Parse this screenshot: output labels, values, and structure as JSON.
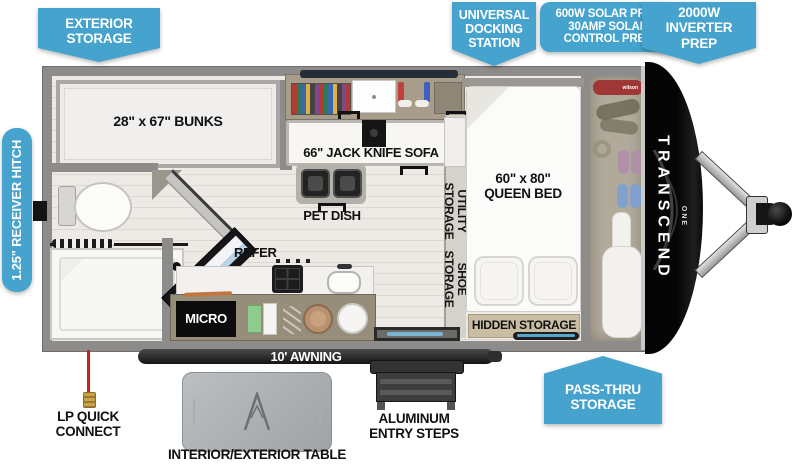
{
  "colors": {
    "callout_blue": "#45a3cd",
    "wall_gray": "#8e8c8a",
    "floor_tan": "#ece9e3",
    "cap_black": "#0d0d0d",
    "label_black": "#111111",
    "awning_black": "#1c1c1c",
    "accent_tray_blue": "#58a8cc"
  },
  "callouts": {
    "exterior_storage": "EXTERIOR STORAGE",
    "universal_docking": "UNIVERSAL DOCKING STATION",
    "solar": {
      "lines": [
        "600W SOLAR PREP",
        "30AMP SOLAR",
        "CONTROL PREP"
      ]
    },
    "inverter": "2000W INVERTER PREP",
    "receiver_hitch": "1.25\" RECEIVER HITCH",
    "pass_thru": "PASS-THRU STORAGE"
  },
  "rooms": {
    "bunks": "28\" x 67\" BUNKS",
    "sofa": "66\" JACK KNIFE SOFA",
    "pet_dish": "PET DISH",
    "refer": "REFER",
    "micro": "MICRO",
    "utility_storage": "UTILITY STORAGE",
    "shoe_storage": "SHOE STORAGE",
    "queen_bed": {
      "lines": [
        "60\" x 80\"",
        "QUEEN BED"
      ]
    },
    "hidden_storage": "HIDDEN STORAGE",
    "awning": "10' AWNING"
  },
  "exterior": {
    "lp_quick_connect": "LP QUICK CONNECT",
    "table": "INTERIOR/EXTERIOR TABLE",
    "entry_steps": "ALUMINUM ENTRY STEPS"
  },
  "brand": {
    "name": "TRANSCEND",
    "series": "ONE",
    "accessory": "wilson"
  }
}
